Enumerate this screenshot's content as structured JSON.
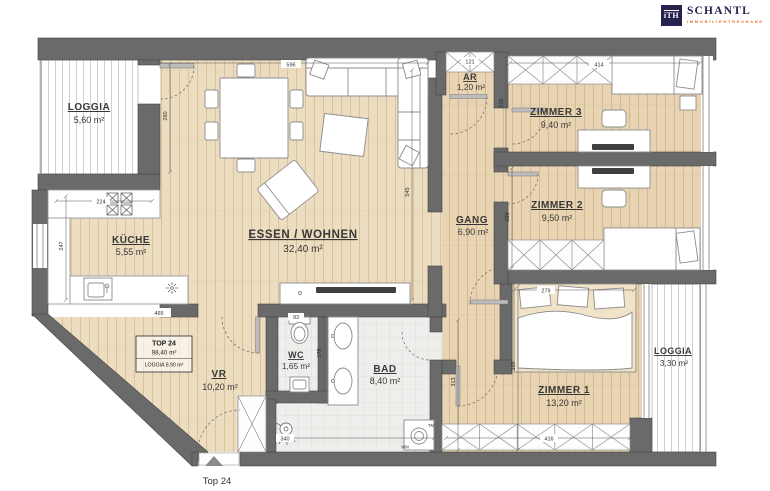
{
  "logo": {
    "mark": "iTH",
    "name": "SCHANTL",
    "subtitle": "IMMOBILIENTREUHAND"
  },
  "entrance": {
    "label": "Top 24"
  },
  "info_box": {
    "title": "TOP 24",
    "area": "98,40 m²",
    "loggia": "LOGGIA 8,90 m²"
  },
  "rooms": {
    "loggia_tl": {
      "name": "LOGGIA",
      "area": "5,60 m²"
    },
    "kueche": {
      "name": "KÜCHE",
      "area": "5,55 m²"
    },
    "essen_wohnen": {
      "name": "ESSEN / WOHNEN",
      "area": "32,40 m²"
    },
    "ar": {
      "name": "AR",
      "area": "1,20 m²"
    },
    "gang": {
      "name": "GANG",
      "area": "6,90 m²"
    },
    "zimmer3": {
      "name": "ZIMMER 3",
      "area": "9,40 m²"
    },
    "zimmer2": {
      "name": "ZIMMER 2",
      "area": "9,50 m²"
    },
    "zimmer1": {
      "name": "ZIMMER 1",
      "area": "13,20 m²"
    },
    "wc": {
      "name": "WC",
      "area": "1,65 m²"
    },
    "bad": {
      "name": "BAD",
      "area": "8,40 m²"
    },
    "vr": {
      "name": "VR",
      "area": "10,20 m²"
    },
    "loggia_br": {
      "name": "LOGGIA",
      "area": "3,30 m²"
    }
  },
  "appliances": {
    "washing_machine": "WM",
    "dryer_mark": "TM"
  },
  "dims": {
    "d596": "596",
    "d121": "121",
    "d414": "414",
    "d260": "260",
    "d226": "226",
    "d545": "545",
    "d224": "224",
    "d247": "247",
    "d465": "465",
    "d229": "229",
    "d279": "279",
    "d388": "388",
    "d416": "416",
    "d93": "93",
    "d179": "179",
    "d313": "313",
    "d340": "340"
  },
  "colors": {
    "wall": "#6a6a6a",
    "wood": "#ecdcc0",
    "wood_dark": "#e8d4b2",
    "tile": "#eeeeec",
    "logo_navy": "#272350",
    "logo_orange": "#e56f2e"
  }
}
